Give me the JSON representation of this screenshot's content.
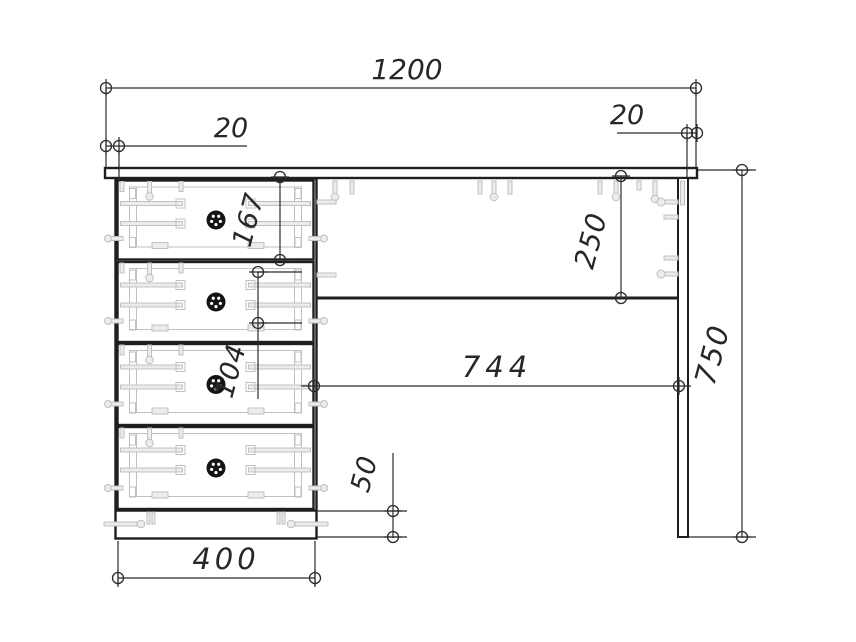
{
  "drawing": {
    "type": "furniture-technical-drawing",
    "subject": "desk-front-elevation",
    "units": "mm",
    "colors": {
      "line": "#1f1f1f",
      "dim": "#2b2b2b",
      "detail": "#c0c0c0",
      "detail_fill": "#ececec",
      "knob": "#141414",
      "background": "#ffffff"
    },
    "dimensions": [
      {
        "name": "overall-width",
        "label": "1200",
        "value": 1200,
        "orientation": "horizontal"
      },
      {
        "name": "tabletop-left-overhang",
        "label": "20",
        "value": 20,
        "orientation": "horizontal"
      },
      {
        "name": "tabletop-right-overhang",
        "label": "20",
        "value": 20,
        "orientation": "horizontal"
      },
      {
        "name": "top-drawer-front-height",
        "label": "167",
        "value": 167,
        "orientation": "vertical"
      },
      {
        "name": "drawer-box-height",
        "label": "104",
        "value": 104,
        "orientation": "vertical"
      },
      {
        "name": "back-rail-height",
        "label": "250",
        "value": 250,
        "orientation": "vertical"
      },
      {
        "name": "knee-hole-width",
        "label": "744",
        "value": 744,
        "orientation": "horizontal"
      },
      {
        "name": "plinth-height",
        "label": "50",
        "value": 50,
        "orientation": "vertical"
      },
      {
        "name": "pedestal-width",
        "label": "400",
        "value": 400,
        "orientation": "horizontal"
      },
      {
        "name": "overall-height",
        "label": "750",
        "value": 750,
        "orientation": "vertical"
      }
    ],
    "components": {
      "tabletop": "tabletop",
      "pedestal": "drawer-pedestal",
      "drawer_count": 4,
      "leg_panel": "side-leg-panel",
      "back_rail": "back-rail",
      "plinth": "plinth"
    }
  }
}
